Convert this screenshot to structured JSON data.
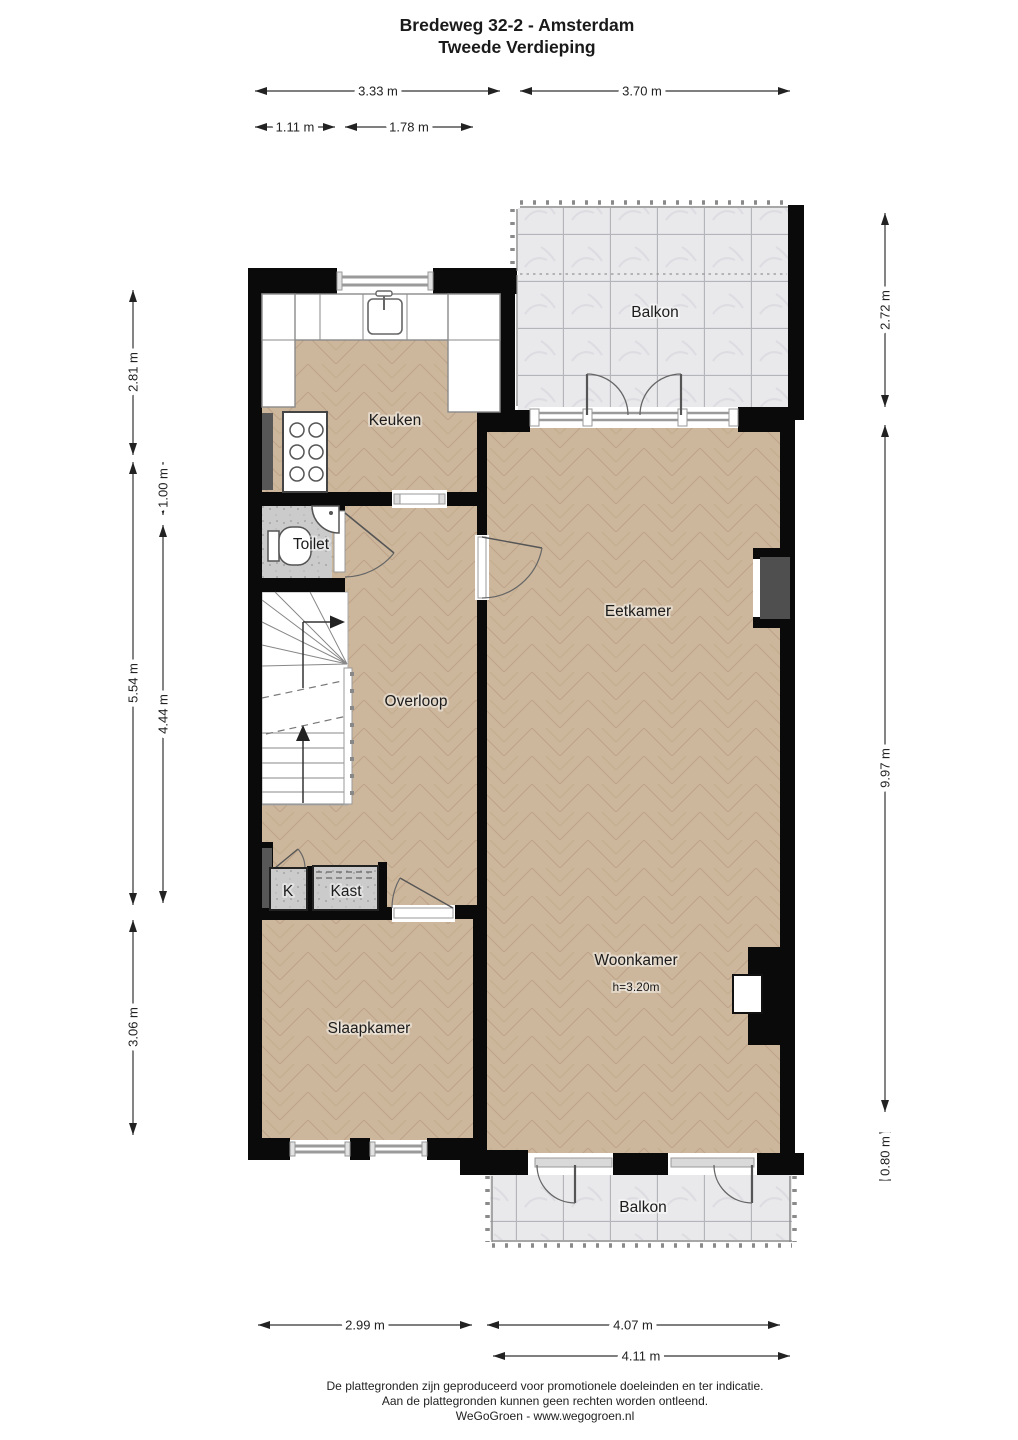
{
  "title": {
    "line1": "Bredeweg 32-2 - Amsterdam",
    "line2": "Tweede Verdieping"
  },
  "rooms": {
    "balkon_top": "Balkon",
    "keuken": "Keuken",
    "toilet": "Toilet",
    "overloop": "Overloop",
    "eetkamer": "Eetkamer",
    "k": "K",
    "kast": "Kast",
    "slaapkamer": "Slaapkamer",
    "woonkamer": "Woonkamer",
    "woonkamer_height": "h=3.20m",
    "balkon_bottom": "Balkon"
  },
  "dimensions": {
    "top_333": "3.33 m",
    "top_370": "3.70 m",
    "top_111": "1.11 m",
    "top_178": "1.78 m",
    "left_281": "2.81 m",
    "left_554": "5.54 m",
    "left_100": "1.00 m",
    "left_444": "4.44 m",
    "left_306": "3.06 m",
    "right_272": "2.72 m",
    "right_997": "9.97 m",
    "right_080": "0.80 m",
    "bottom_299": "2.99 m",
    "bottom_407": "4.07 m",
    "bottom_411": "4.11 m"
  },
  "footer": {
    "line1": "De plattegronden zijn geproduceerd voor promotionele doeleinden en ter indicatie.",
    "line2": "Aan de plattegronden kunnen geen rechten worden ontleend.",
    "line3": "WeGoGroen -  www.wegogroen.nl"
  },
  "colors": {
    "wall": "#0a0a0a",
    "floor_wood": "#cdb79c",
    "floor_tile": "#e9e9ec",
    "floor_service": "#cbcbcb",
    "niche_dark": "#4f4f4f"
  }
}
